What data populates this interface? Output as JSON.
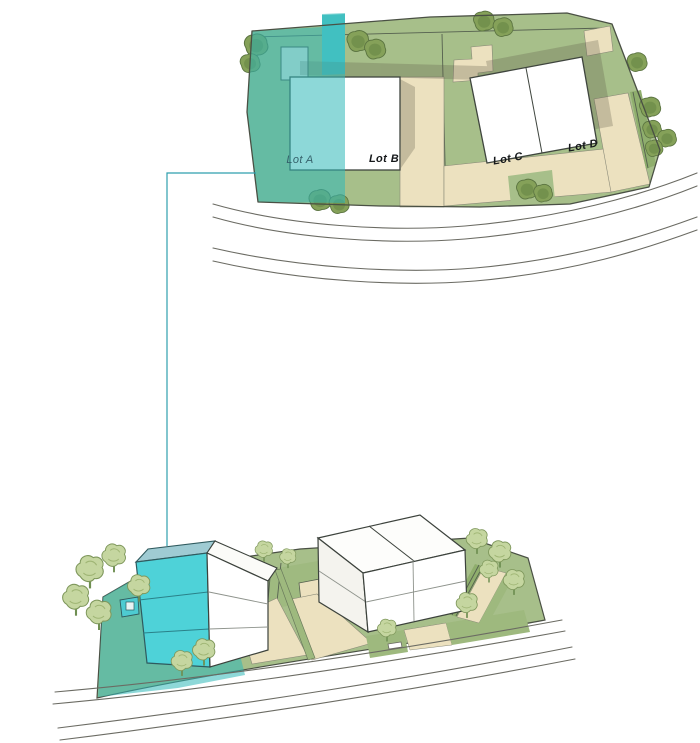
{
  "lots": [
    {
      "label": "Lot A",
      "selected": true
    },
    {
      "label": "Lot B",
      "selected": false
    },
    {
      "label": "Lot C",
      "selected": false
    },
    {
      "label": "Lot D",
      "selected": false
    }
  ],
  "colors": {
    "highlight_teal": "#4ed2d8",
    "highlight_overlay": "#2fb8b8",
    "lawn_green": "#a7bf8a",
    "strip_green": "#9eb97e",
    "edge_green": "#8fae6d",
    "paving_beige": "#ece1bf",
    "building_white": "#ffffff",
    "building_side": "#f4f3ee",
    "roof_teal_gray": "#9fcbd3",
    "shadow_gray": "#5f5a48",
    "tree_olive": "#85a159",
    "tree_light_green": "#c5d6a0",
    "outline_dark": "#4a5044",
    "leader_line_teal": "#2f9fae",
    "road_line_gray": "#6b6b63",
    "label_dark": "#15181a",
    "label_selected": "#35616b"
  }
}
